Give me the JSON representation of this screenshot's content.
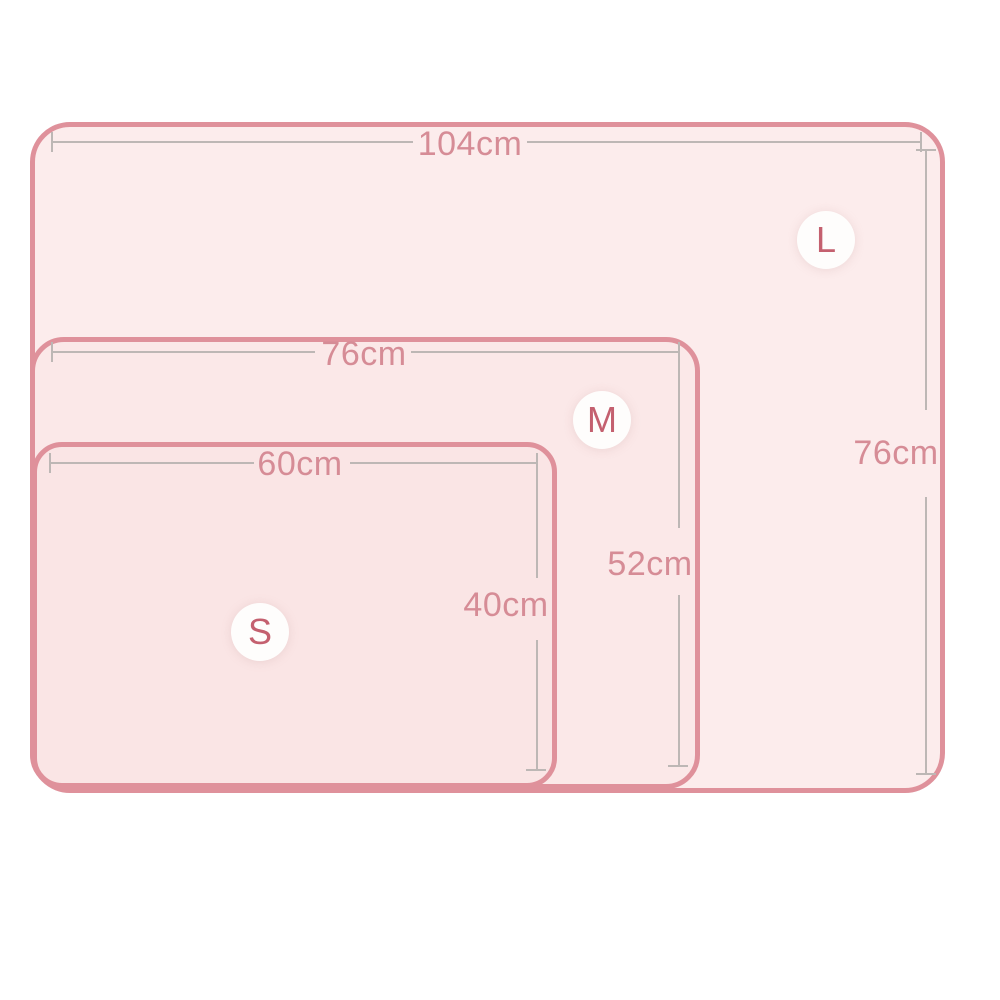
{
  "diagram": {
    "kind": "product-size-chart",
    "unit": "cm"
  },
  "sizes": [
    {
      "badge": "L",
      "width": "104cm",
      "height": "76cm"
    },
    {
      "badge": "M",
      "width": "76cm",
      "height": "52cm"
    },
    {
      "badge": "S",
      "width": "60cm",
      "height": "40cm"
    }
  ],
  "colors": {
    "rect_border": "#df919b",
    "rect_fill_l": "#fcecec",
    "rect_fill_m": "#fbe8e8",
    "rect_fill_s": "#fae5e5",
    "dim_line": "#bdb7b5",
    "dim_text": "#d68c96",
    "badge_text": "#c4606f",
    "badge_bg": "#fefdfc",
    "page_bg": "#ffffff"
  }
}
